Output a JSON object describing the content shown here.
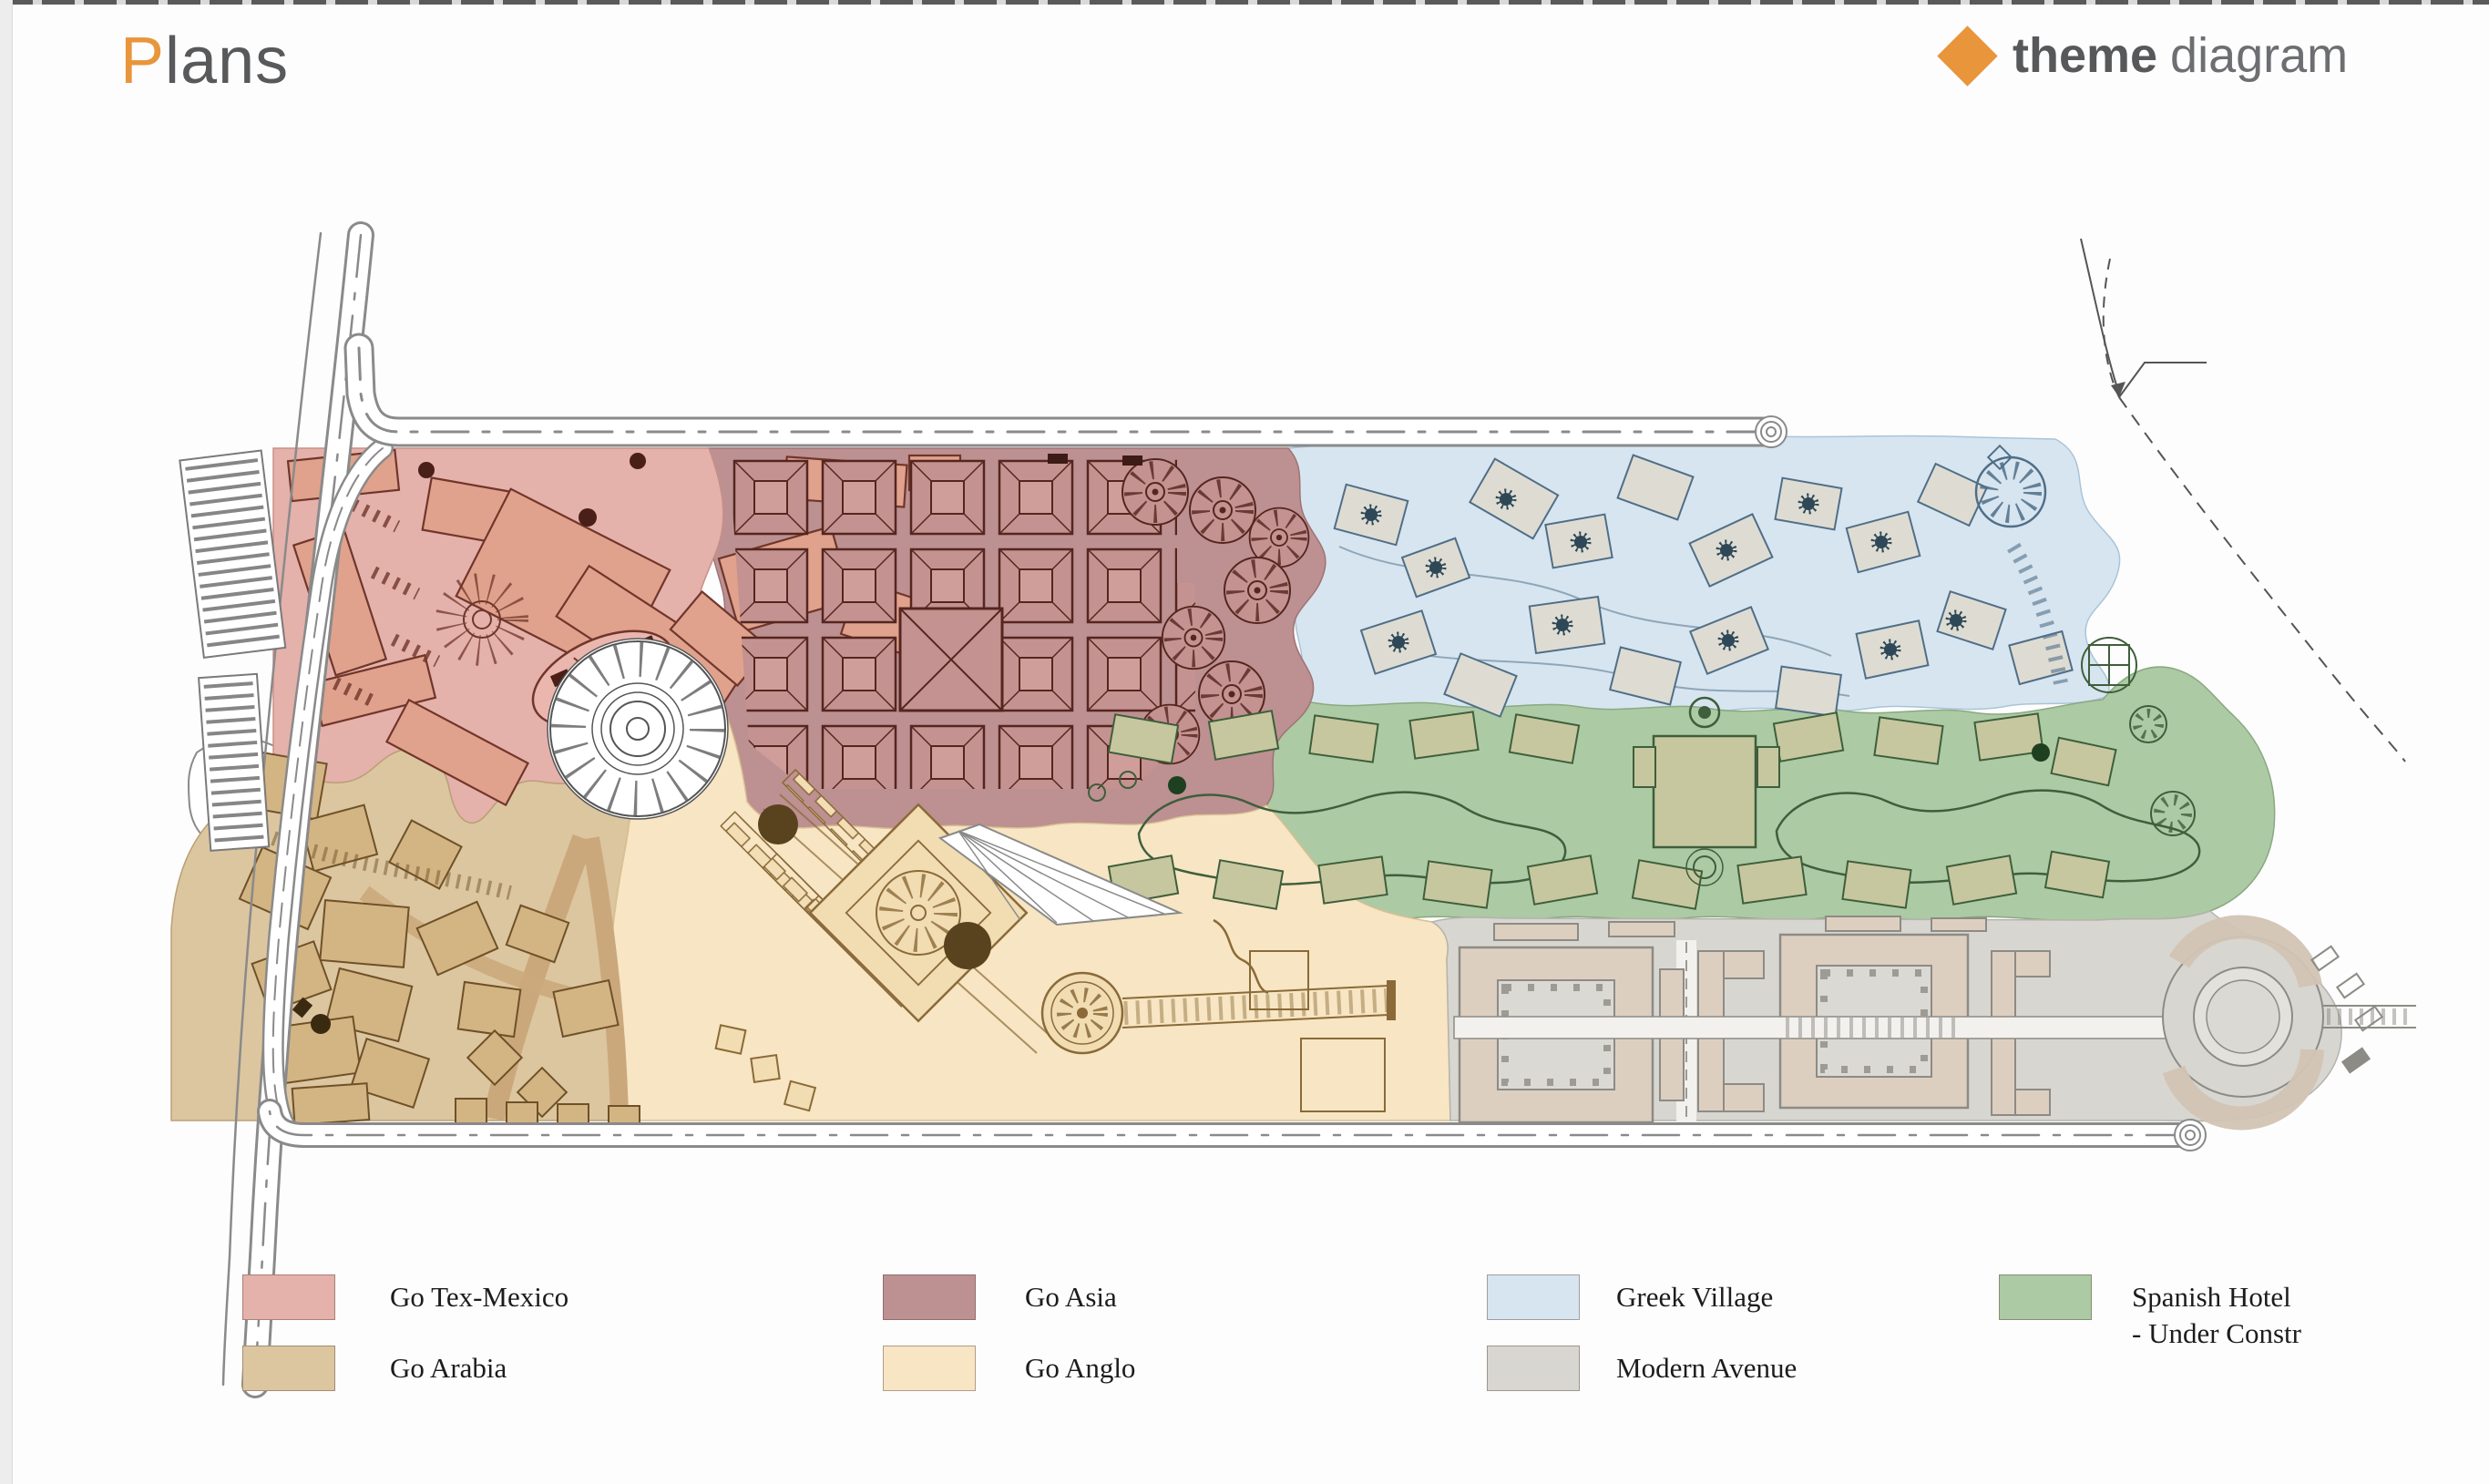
{
  "header": {
    "title_prefix": "P",
    "title_rest": "lans",
    "accent_color": "#e8953c",
    "brand": {
      "bold": "theme",
      "light": "diagram",
      "diamond_color": "#e8953c"
    }
  },
  "legend": {
    "items": [
      {
        "id": "go-tex-mexico",
        "label": "Go Tex-Mexico",
        "color": "#e5b1ab"
      },
      {
        "id": "go-asia",
        "label": "Go Asia",
        "color": "#bd9092"
      },
      {
        "id": "greek-village",
        "label": "Greek Village",
        "color": "#d7e5f0"
      },
      {
        "id": "spanish-hotel",
        "label": "Spanish Hotel",
        "label_line2": "- Under Constr",
        "color": "#accaa3"
      },
      {
        "id": "go-arabia",
        "label": "Go Arabia",
        "color": "#dcc6a0"
      },
      {
        "id": "go-anglo",
        "label": "Go Anglo",
        "color": "#f7e5c3"
      },
      {
        "id": "modern-avenue",
        "label": "Modern Avenue",
        "color": "#d8d6d0"
      }
    ]
  }
}
